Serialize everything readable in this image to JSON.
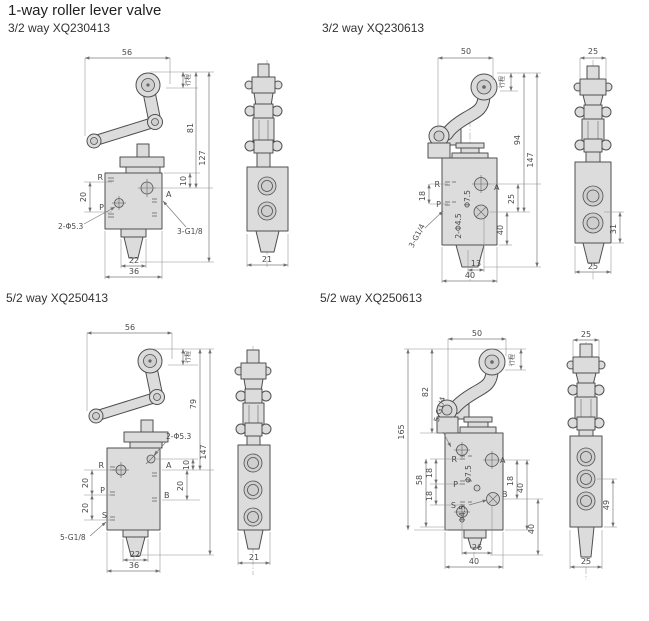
{
  "page": {
    "title": "1-way roller lever valve"
  },
  "panels": {
    "tl": {
      "subtitle": "3/2 way XQ230413",
      "front": {
        "width_top": "56",
        "stroke_label": "行程",
        "height_roller": "81",
        "height_total": "127",
        "port_pitch": "20",
        "port_offset": "10",
        "mount_holes": "2-Φ5.3",
        "port_thread": "3-G1/8",
        "port_r": "R",
        "port_p": "P",
        "port_a": "A",
        "base_inner": "22",
        "base_outer": "36"
      },
      "side": {
        "width_bottom": "21"
      }
    },
    "tr": {
      "subtitle": "3/2 way XQ230613",
      "front": {
        "width_top": "50",
        "stroke_label": "行程",
        "height_roller": "94",
        "height_total": "147",
        "port_pitch": "18",
        "port_thread": "3-G1/4",
        "mount_holes": "2-Φ4.5",
        "counterbore": "Φ7.5",
        "port_r": "R",
        "port_p": "P",
        "port_a": "A",
        "right_pitch": "25",
        "right_span": "40",
        "base_inner": "13",
        "base_outer": "40"
      },
      "side": {
        "width_top": "25",
        "port_span": "31",
        "width_bottom": "25"
      }
    },
    "bl": {
      "subtitle": "5/2 way XQ250413",
      "front": {
        "width_top": "56",
        "stroke_label": "行程",
        "height_roller": "79",
        "height_total": "147",
        "port_pitch1": "20",
        "port_pitch2": "20",
        "port_offset": "10",
        "right_pitch": "20",
        "mount_holes": "2-Φ5.3",
        "port_thread": "5-G1/8",
        "port_r": "R",
        "port_p": "P",
        "port_s": "S",
        "port_a": "A",
        "port_b": "B",
        "base_inner": "22",
        "base_outer": "36"
      },
      "side": {
        "width_bottom": "21"
      }
    },
    "br": {
      "subtitle": "5/2 way XQ250613",
      "front": {
        "width_top": "50",
        "stroke_label": "行程",
        "height_roller": "82",
        "height_total": "165",
        "port_span_left": "58",
        "port_pitch1": "18",
        "port_pitch2": "18",
        "port_thread": "5-G1/4",
        "counterbore": "Φ7.5",
        "hole": "Φ4.5",
        "port_r": "R",
        "port_p": "P",
        "port_s": "S",
        "port_a": "A",
        "port_b": "B",
        "right_pitch": "18",
        "right_span1": "40",
        "right_span2": "40",
        "base_inner": "26",
        "base_outer": "40"
      },
      "side": {
        "width_top": "25",
        "port_span": "49",
        "width_bottom": "25"
      }
    }
  }
}
